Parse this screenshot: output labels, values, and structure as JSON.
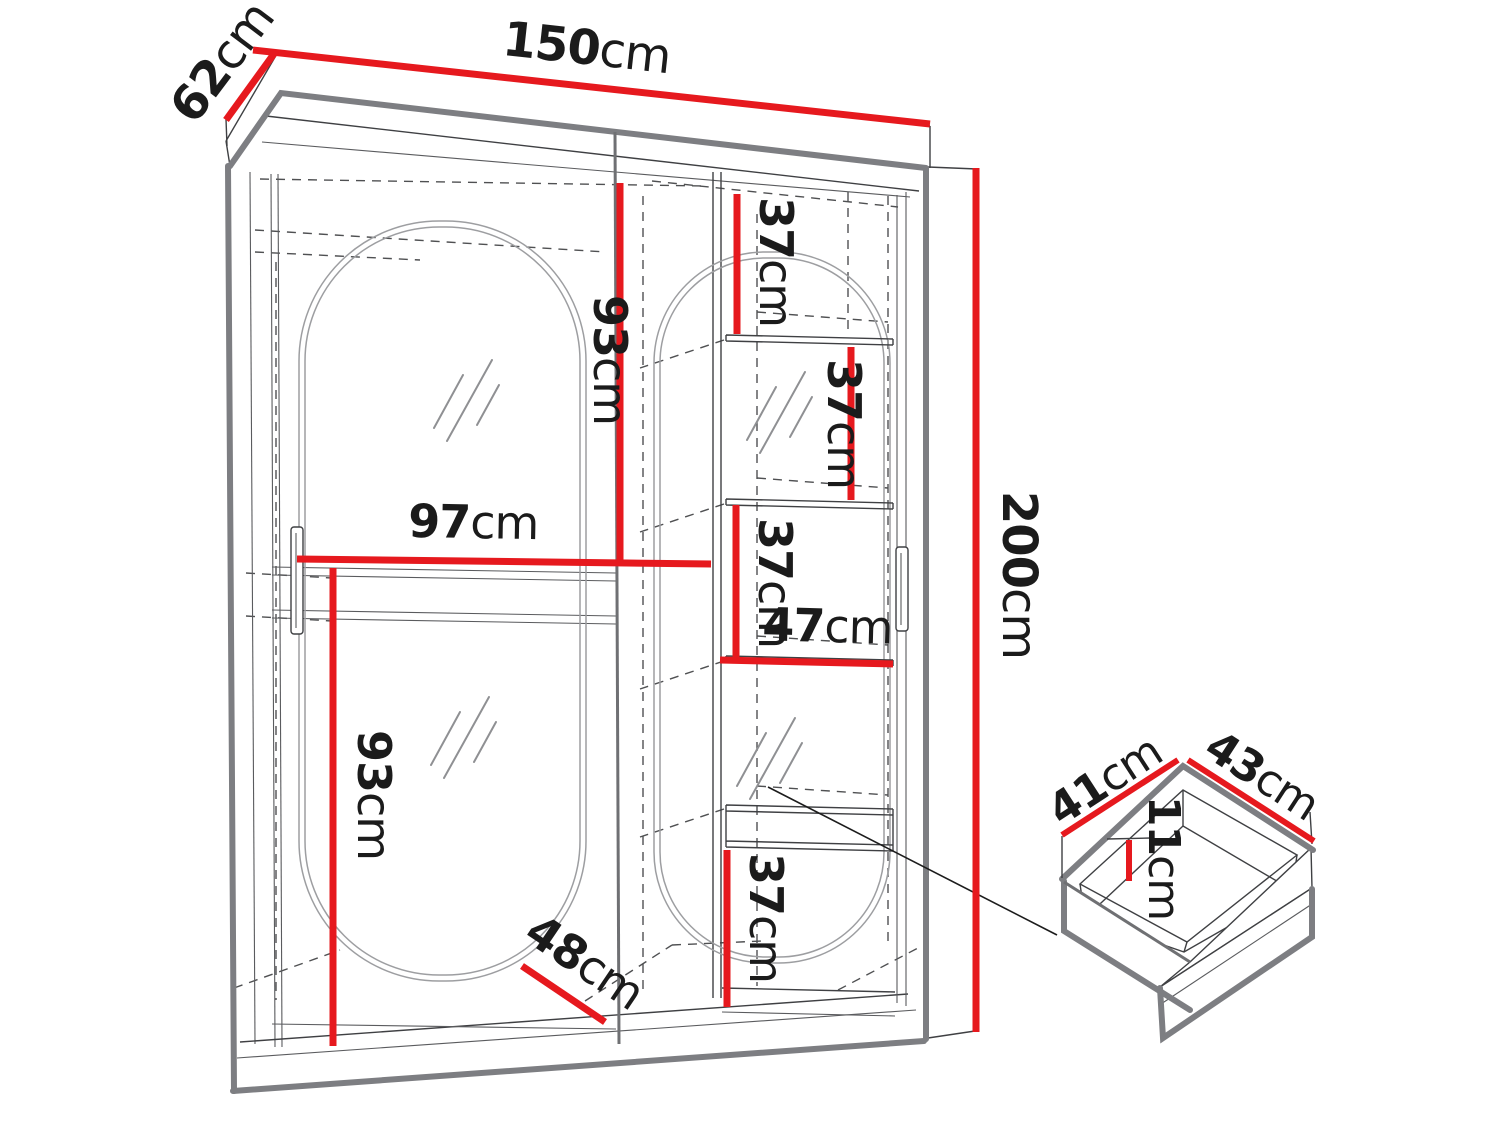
{
  "diagram": {
    "unit": "cm",
    "colors": {
      "dimension_red": "#e6191e",
      "outline_gray": "#7d7e82"
    },
    "dims": {
      "width": {
        "num": "150",
        "unit": "cm"
      },
      "depth": {
        "num": "62",
        "unit": "cm"
      },
      "height": {
        "num": "200",
        "unit": "cm"
      },
      "upper_left_height": {
        "num": "93",
        "unit": "cm"
      },
      "left_width": {
        "num": "97",
        "unit": "cm"
      },
      "lower_left_height": {
        "num": "93",
        "unit": "cm"
      },
      "shelf_gap_1": {
        "num": "37",
        "unit": "cm"
      },
      "shelf_gap_2": {
        "num": "37",
        "unit": "cm"
      },
      "shelf_gap_3": {
        "num": "37",
        "unit": "cm"
      },
      "right_width": {
        "num": "47",
        "unit": "cm"
      },
      "shelf_gap_4": {
        "num": "37",
        "unit": "cm"
      },
      "floor_depth": {
        "num": "48",
        "unit": "cm"
      },
      "drawer_depth": {
        "num": "41",
        "unit": "cm"
      },
      "drawer_width": {
        "num": "43",
        "unit": "cm"
      },
      "drawer_height": {
        "num": "11",
        "unit": "cm"
      }
    }
  }
}
